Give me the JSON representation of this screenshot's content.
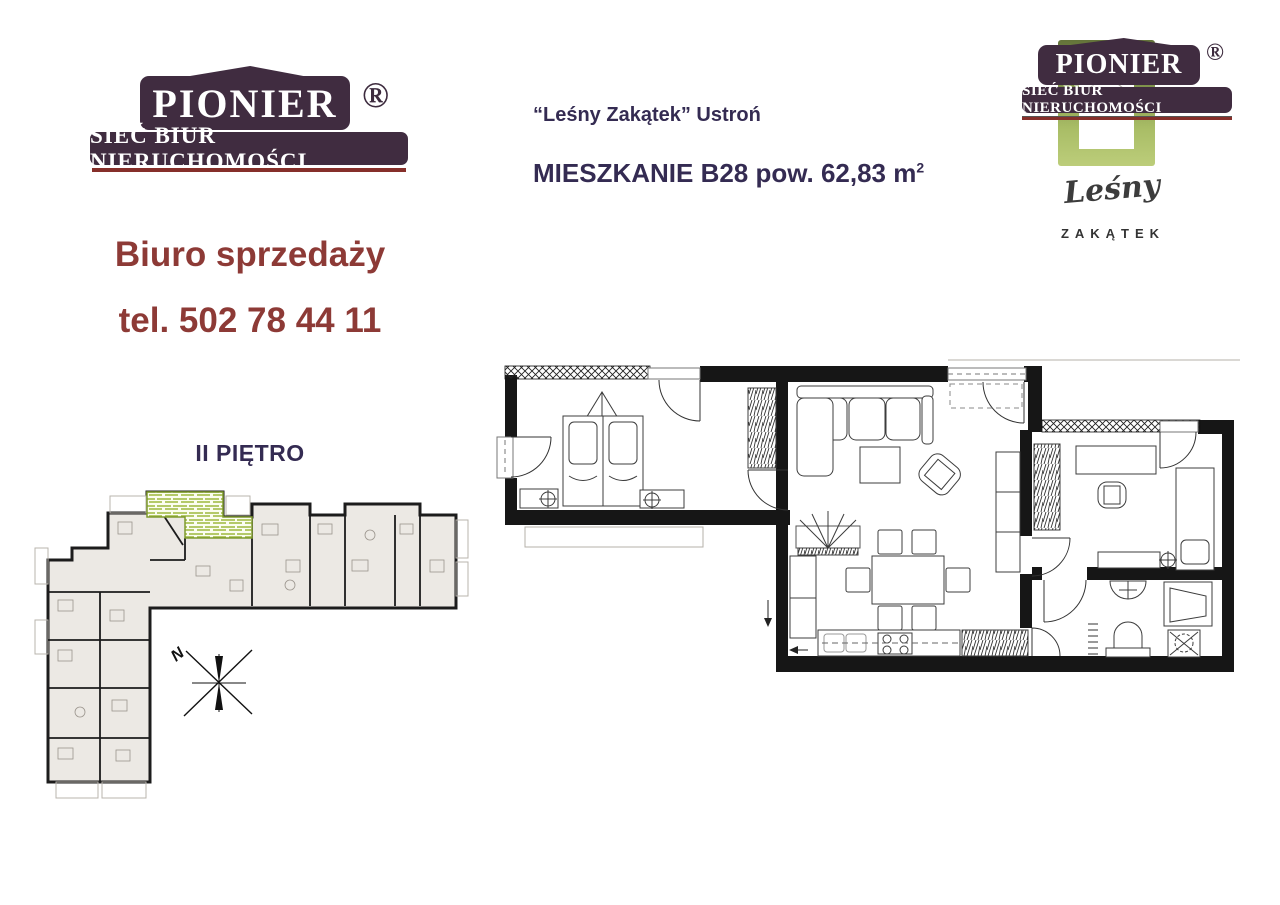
{
  "brand_main": {
    "name": "PIONIER",
    "subtitle": "SIEĆ BIUR NIERUCHOMOŚCI",
    "registered": "®"
  },
  "brand_corner": {
    "name": "PIONIER",
    "subtitle": "SIEĆ BIUR NIERUCHOMOŚCI",
    "registered": "®"
  },
  "estate_logo": {
    "script": "Leśny",
    "caps": "ZAKĄTEK"
  },
  "header": {
    "project_line": "“Leśny Zakątek” Ustroń",
    "apartment_line": "MIESZKANIE B28 pow. 62,83 m",
    "apartment_area_sup": "2"
  },
  "sales_office": {
    "line1": "Biuro sprzedaży",
    "line2": "tel. 502 78 44 11"
  },
  "floor_label": "II PIĘTRO",
  "overview": {
    "compass_north_label": "N"
  },
  "colors": {
    "logo_background": "#402c40",
    "logo_underline": "#862f2a",
    "heading_text": "#342b52",
    "sales_text": "#8d3a36",
    "plan_walls": "#161616",
    "overview_unit_fill": "#ece9e4",
    "highlight_hatch_green": "#a6c23f"
  }
}
